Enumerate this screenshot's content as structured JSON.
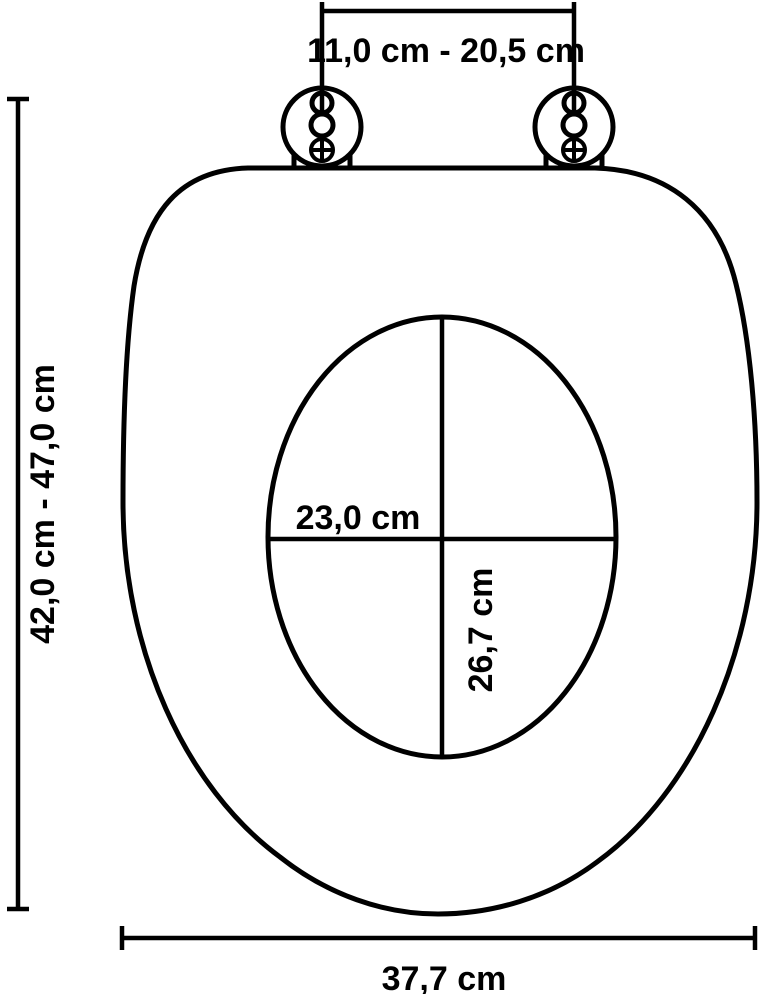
{
  "colors": {
    "line": "#000000",
    "background": "#ffffff",
    "text": "#000000"
  },
  "dimension_labels": {
    "hinge_distance": "11,0 cm - 20,5 cm",
    "seat_length_range": "42,0 cm - 47,0 cm",
    "opening_width": "23,0 cm",
    "opening_length": "26,7 cm",
    "seat_width": "37,7 cm"
  }
}
